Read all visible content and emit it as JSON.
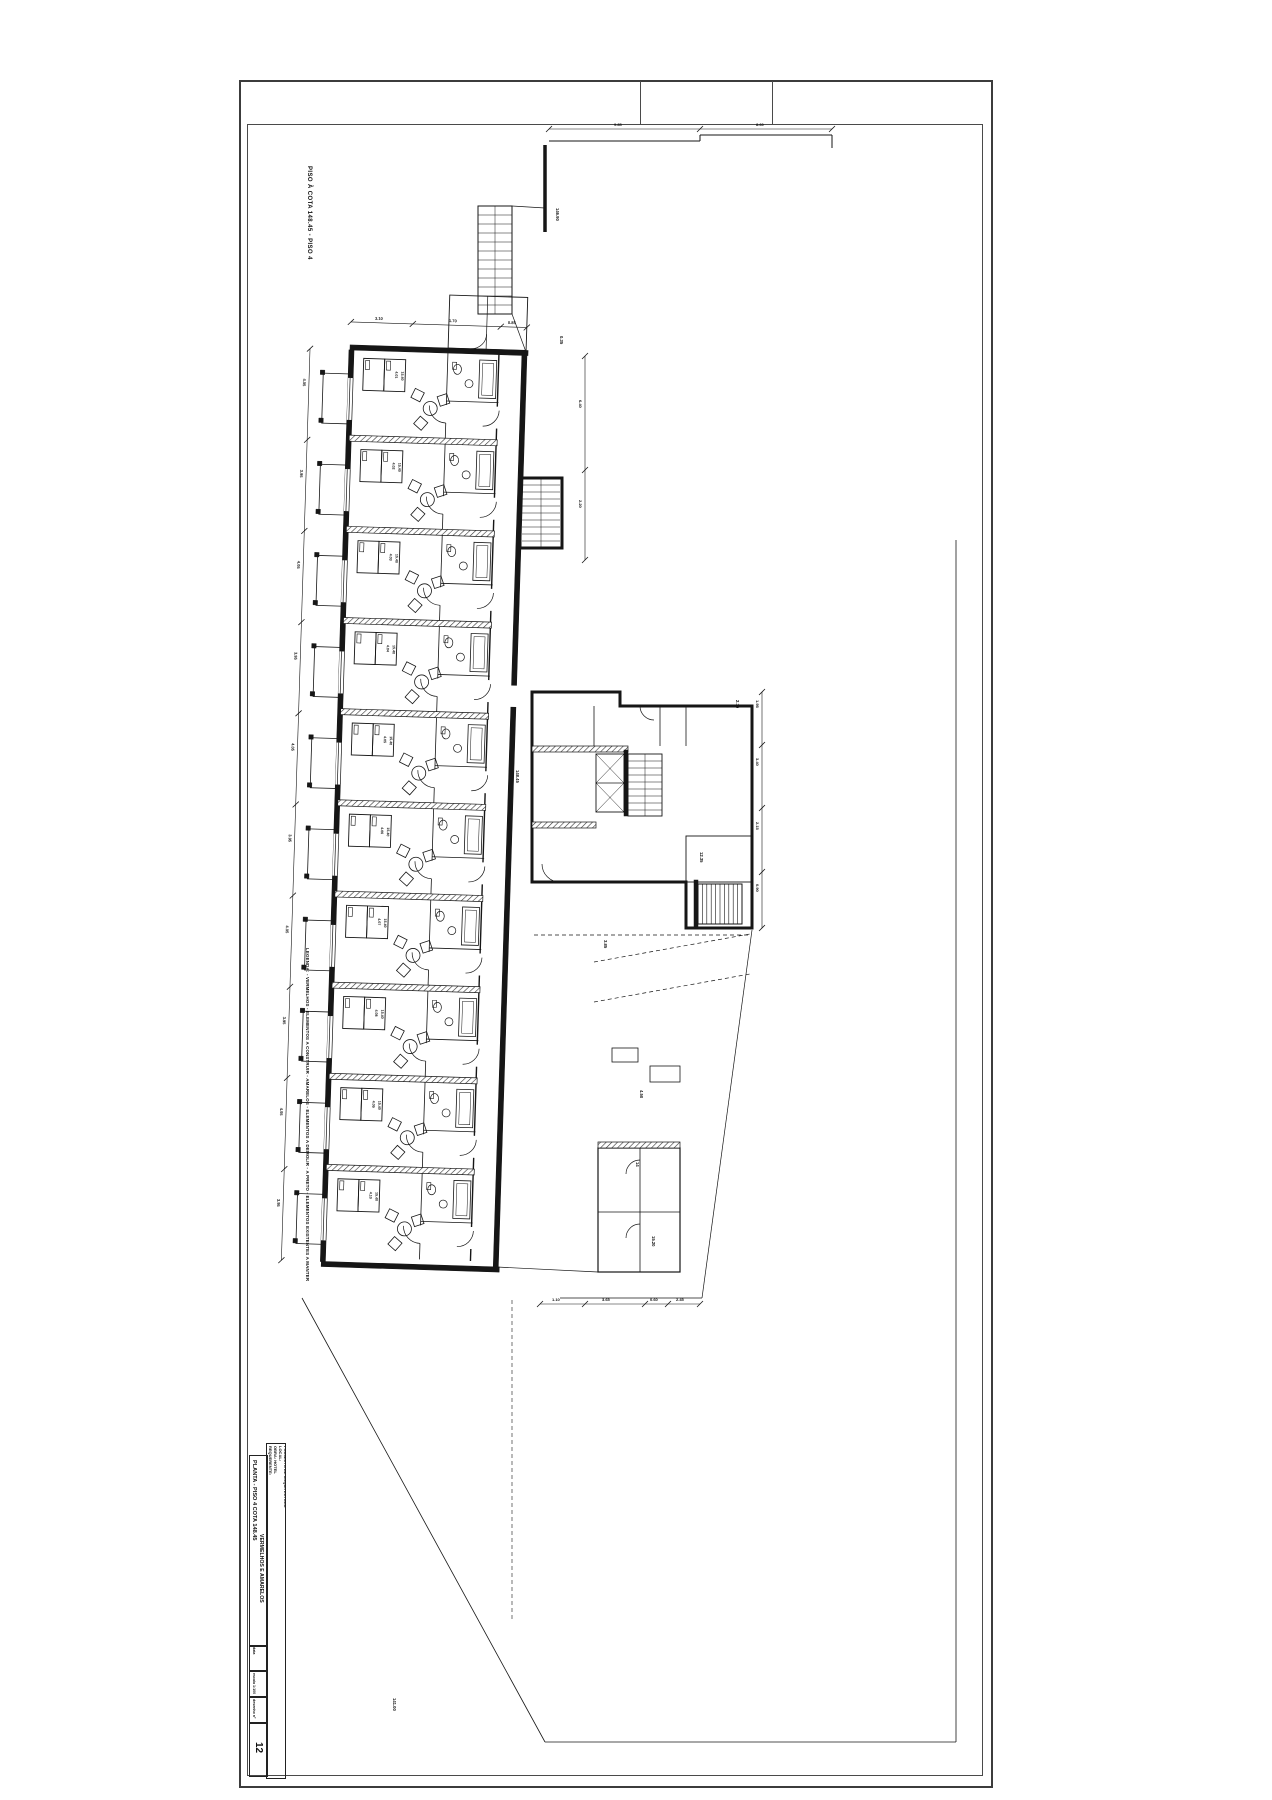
{
  "sheet": {
    "margin_note": "PISO À COTA 148.45 - PISO 4",
    "legend": "LEGENDA:  - VERMELHOS - ELEMENTOS A CONSTRUIR   - AMARELOS - ELEMENTOS A DEMOLIR   - A PRETO - ELEMENTOS EXISTENTES A MANTER",
    "title_block": {
      "info_lines": [
        "REQUERENTE:",
        "OBRA: HOTEL",
        "LOCAL:",
        "PROJECTO DE ARQUITECTURA",
        "ALTERAÇÕES - VERMELHOS E AMARELOS",
        "PLANTA - PISO 4",
        "COTA 148.45"
      ],
      "title_line1": "PLANTA - PISO 4 COTA 148.45",
      "title_line2": "VERMELHOS E AMARELOS",
      "fields": [
        {
          "label": "data",
          "value": ""
        },
        {
          "label": "escala",
          "value": "1:100"
        },
        {
          "label": "desenho nº",
          "value": ""
        }
      ],
      "sheet_number": "12"
    }
  },
  "plan": {
    "rooms": [
      {
        "num": "4.01",
        "area": "15.40"
      },
      {
        "num": "4.02",
        "area": "15.40"
      },
      {
        "num": "4.03",
        "area": "15.40"
      },
      {
        "num": "4.04",
        "area": "15.40"
      },
      {
        "num": "4.05",
        "area": "15.40"
      },
      {
        "num": "4.06",
        "area": "15.40"
      },
      {
        "num": "4.07",
        "area": "15.40"
      },
      {
        "num": "4.08",
        "area": "15.40"
      },
      {
        "num": "4.09",
        "area": "15.40"
      },
      {
        "num": "4.10",
        "area": "15.40"
      }
    ],
    "dims_left": [
      "4.05",
      "3.95",
      "4.05",
      "3.95",
      "4.05",
      "3.95",
      "4.05",
      "3.95",
      "4.05",
      "3.95"
    ],
    "dims_top": [
      "3.10",
      "1.70",
      "0.85"
    ],
    "dims_right": [
      "1.95",
      "3.40",
      "2.15",
      "0.90"
    ],
    "dims_bottom": [
      "1.10",
      "3.65",
      "0.60",
      "2.45"
    ],
    "dims_corridor": [
      "6.40",
      "2.20"
    ],
    "dims_site": [
      "9.85",
      "8.60"
    ],
    "notes": [
      {
        "x": 516,
        "y": 770,
        "t": "148.45"
      },
      {
        "x": 556,
        "y": 208,
        "t": "146.90"
      },
      {
        "x": 393,
        "y": 1698,
        "t": "141.00"
      },
      {
        "x": 652,
        "y": 1236,
        "t": "15.20"
      },
      {
        "x": 636,
        "y": 1162,
        "t": "14"
      },
      {
        "x": 700,
        "y": 852,
        "t": "12.35"
      },
      {
        "x": 640,
        "y": 1090,
        "t": "4.50"
      },
      {
        "x": 604,
        "y": 940,
        "t": "3.85"
      },
      {
        "x": 736,
        "y": 700,
        "t": "2.10"
      },
      {
        "x": 560,
        "y": 336,
        "t": "0.35"
      }
    ]
  }
}
